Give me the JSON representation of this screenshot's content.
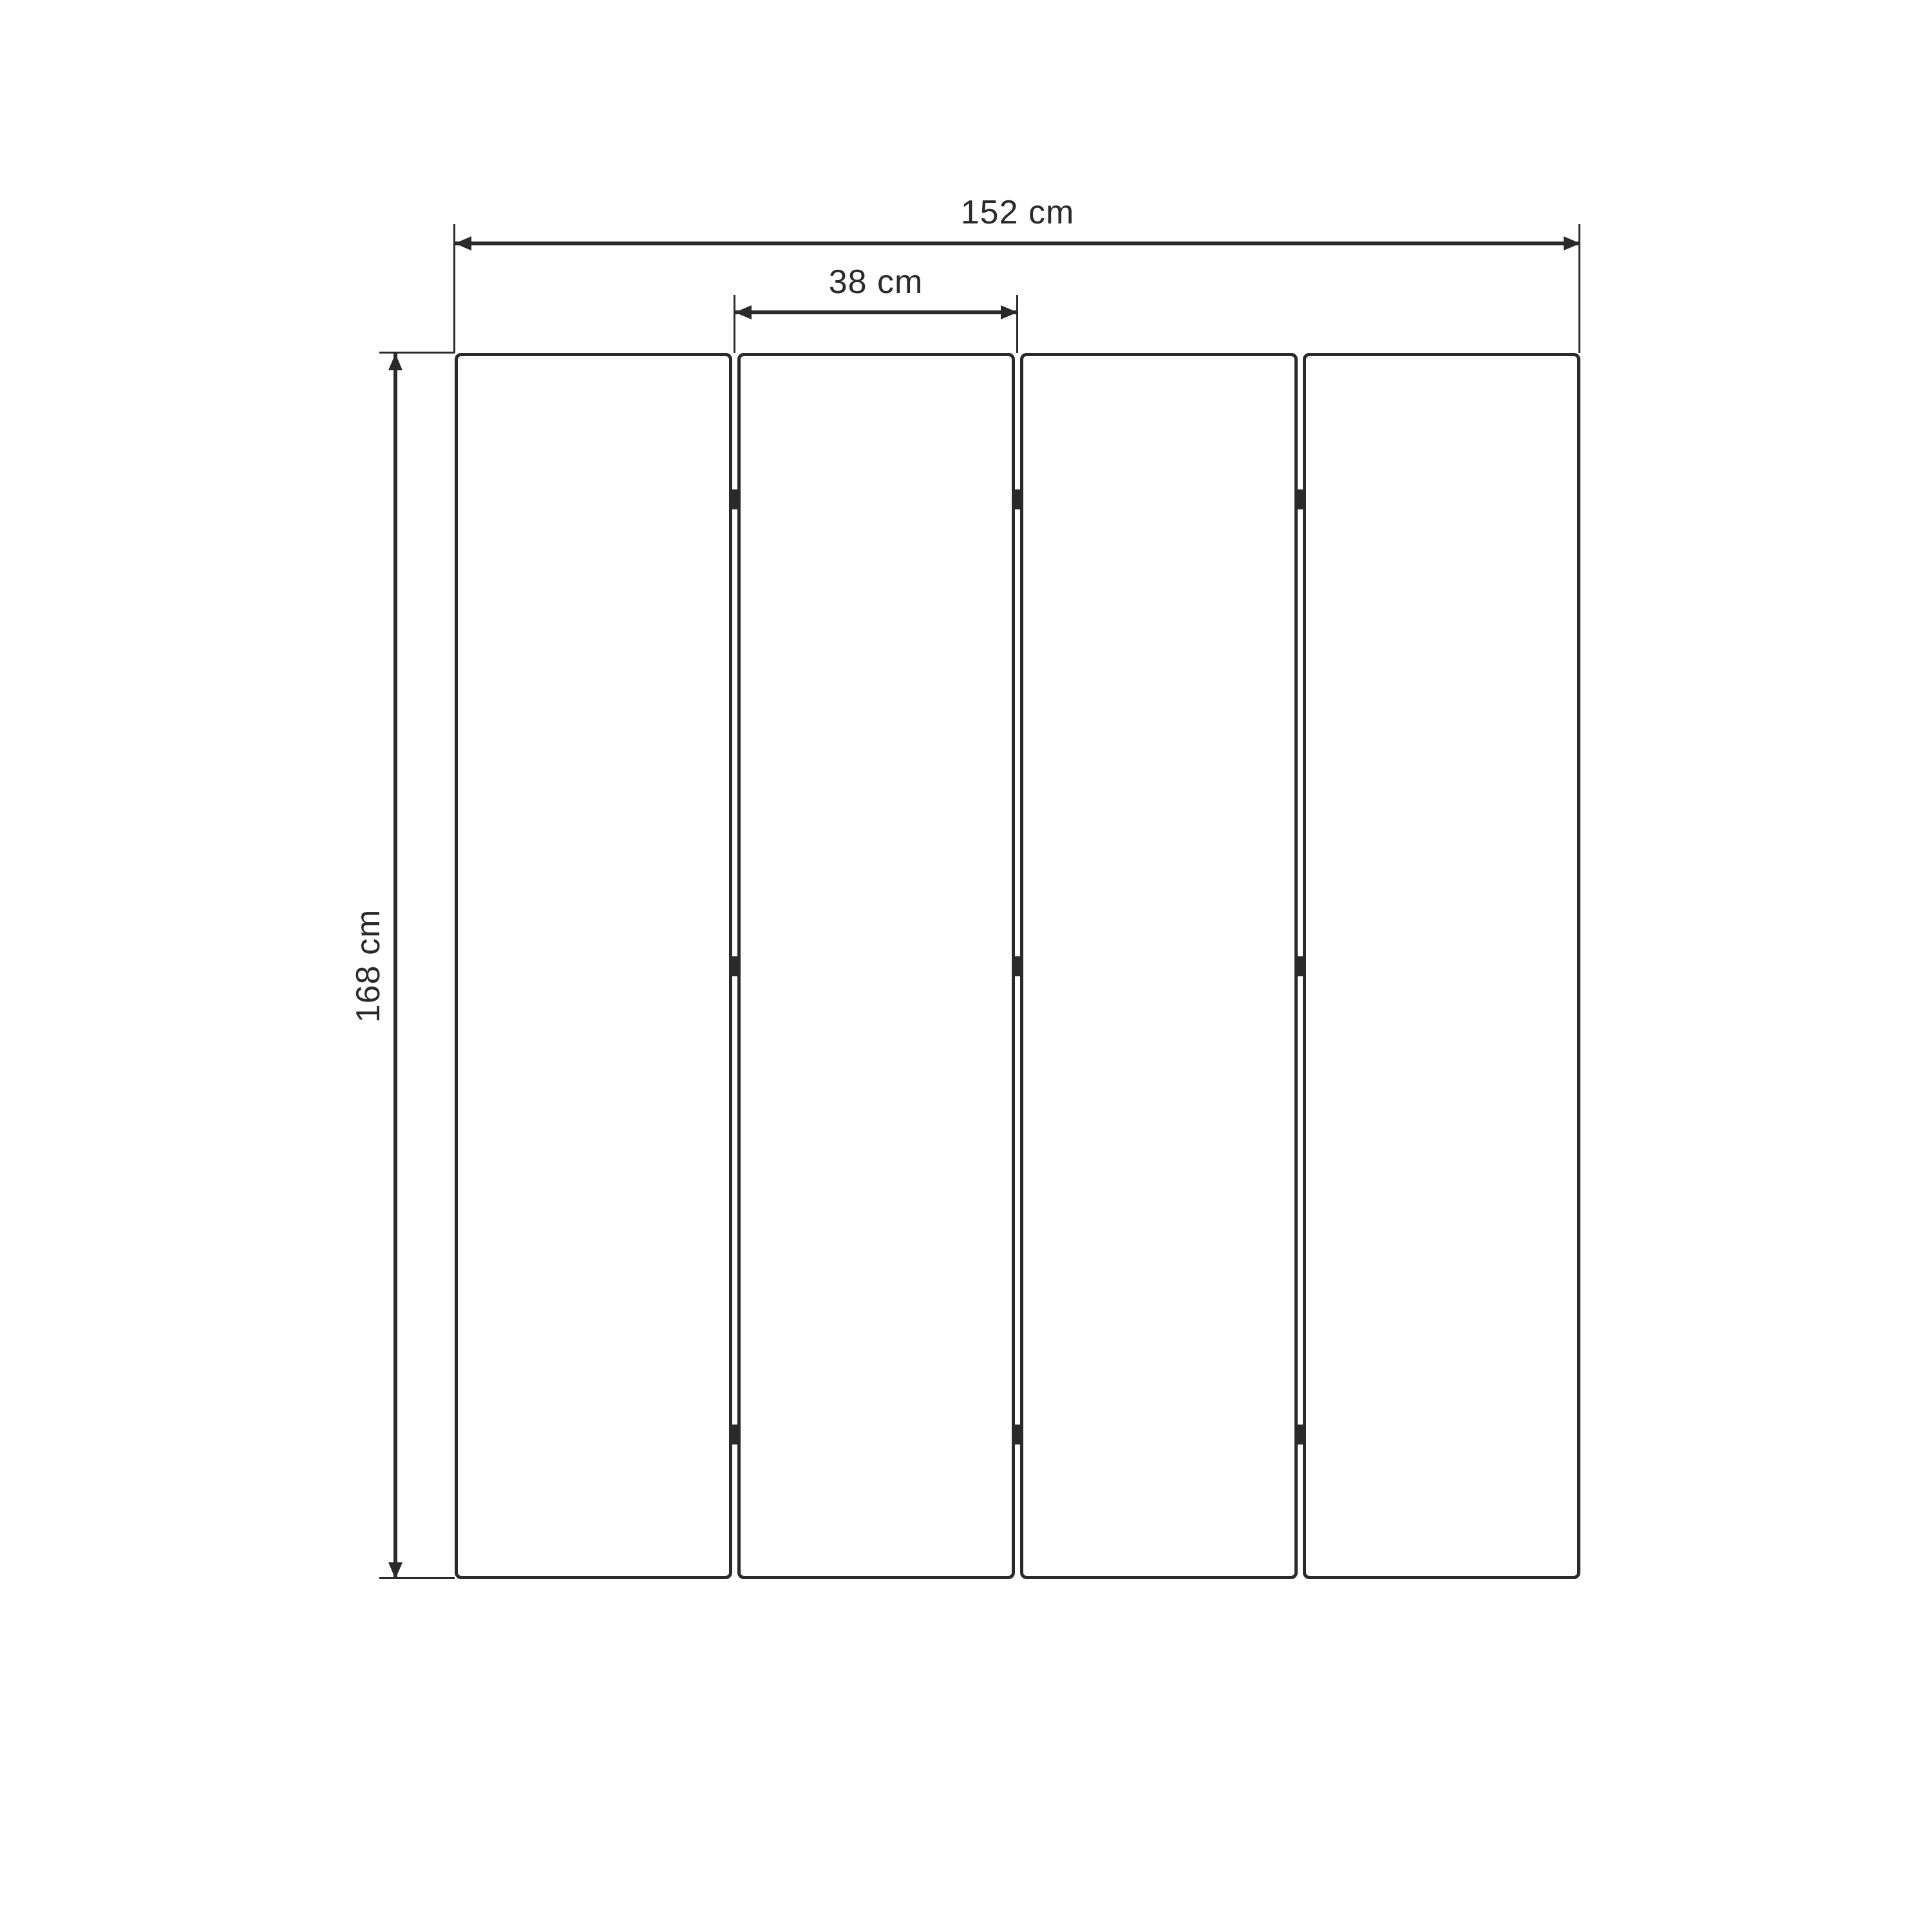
{
  "diagram": {
    "type": "technical-dimension-drawing",
    "subject": "four-panel folding screen, front view",
    "background_color": "#ffffff",
    "line_color": "#2a2a2a",
    "panel_count": 4,
    "hinge_marks_per_gap": 3,
    "dimensions": {
      "total_width": {
        "label": "152 cm"
      },
      "panel_width": {
        "label": "38 cm"
      },
      "height": {
        "label": "168 cm"
      }
    }
  }
}
